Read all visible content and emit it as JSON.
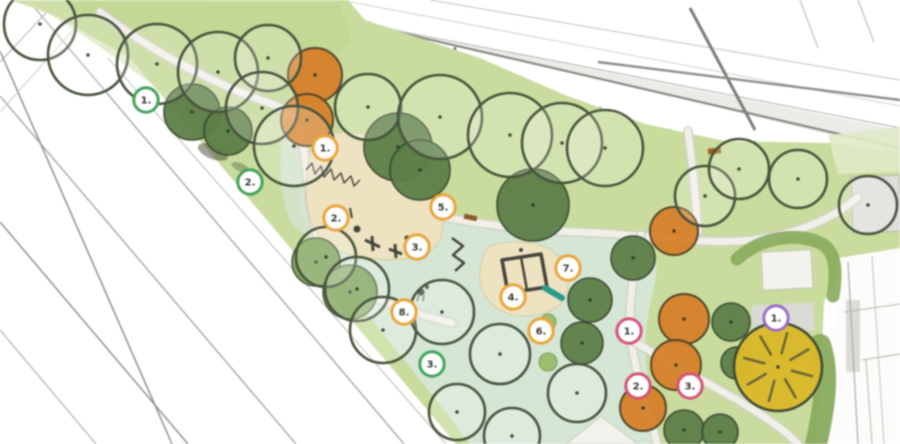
{
  "meta": {
    "width": 900,
    "height": 444,
    "description": "Park landscape site plan, top view"
  },
  "colors": {
    "canvas": "#ffffff",
    "lawn": "#c9dc9e",
    "lawn_shade": "#bdd48d",
    "lawn_light": "#e0eac8",
    "mint": "#d5e6d5",
    "sand": "#ede3c2",
    "sand_edge": "#d8caa2",
    "path_fill": "#f0efe8",
    "path_edge": "#cfcfc6",
    "paved": "#dededa",
    "hedge": "#8aab5f",
    "shrub": "#9dbd72",
    "equip": "#45443c",
    "teal": "#2b9b8b",
    "bench": "#8a5a2a",
    "tree_outline_stroke": "#48543e",
    "tree_dark": "#5d7f49",
    "tree_mid": "#7ca258",
    "tree_orange": "#d5822e",
    "tree_yellow": "#d9b92f",
    "marker_fill": "#ffffff",
    "marker_text": "#3a3a33",
    "ring_orange": "#eaa53e",
    "ring_green": "#46a25c",
    "ring_red": "#d45377",
    "ring_purple": "#9b6fc3"
  },
  "shapes": [
    {
      "k": "line",
      "x1": 126,
      "y1": 52,
      "x2": 460,
      "y2": 444,
      "w": 1.6,
      "c": "#96968f",
      "name": "street-edge"
    },
    {
      "k": "line",
      "x1": 108,
      "y1": 58,
      "x2": 446,
      "y2": 444,
      "w": 1,
      "c": "#b6b6b0",
      "name": "street-line"
    },
    {
      "k": "line",
      "x1": 28,
      "y1": 0,
      "x2": 404,
      "y2": 444,
      "w": 1.3,
      "c": "#a0a09a",
      "name": "street-line"
    },
    {
      "k": "line",
      "x1": 0,
      "y1": 96,
      "x2": 296,
      "y2": 444,
      "w": 1.3,
      "c": "#a0a09a",
      "name": "street-line"
    },
    {
      "k": "line",
      "x1": 0,
      "y1": 222,
      "x2": 188,
      "y2": 444,
      "w": 1.5,
      "c": "#92928c",
      "name": "street-line"
    },
    {
      "k": "line",
      "x1": 0,
      "y1": 330,
      "x2": 96,
      "y2": 444,
      "w": 1.1,
      "c": "#aaaaa4",
      "name": "street-line"
    },
    {
      "k": "line",
      "x1": 0,
      "y1": 51,
      "x2": 172,
      "y2": 444,
      "w": 1.5,
      "c": "#90908a",
      "name": "street-line"
    },
    {
      "k": "line",
      "x1": 0,
      "y1": 62,
      "x2": 58,
      "y2": 0,
      "w": 1.1,
      "c": "#a8a8a2",
      "name": "street-line"
    },
    {
      "k": "line",
      "x1": 0,
      "y1": 112,
      "x2": 100,
      "y2": 0,
      "w": 0.9,
      "c": "#c0c0ba",
      "name": "street-line"
    },
    {
      "k": "path",
      "d": "M 238,0 L 278,0 L 900,152 L 900,130 Z",
      "f": "#dadad6",
      "op": 0.55,
      "name": "road-band"
    },
    {
      "k": "line",
      "x1": 236,
      "y1": 0,
      "x2": 560,
      "y2": 62,
      "w": 1,
      "c": "#aeaea8",
      "name": "road-line"
    },
    {
      "k": "line",
      "x1": 560,
      "y1": 62,
      "x2": 900,
      "y2": 128,
      "w": 1,
      "c": "#aeaea8",
      "name": "road-line"
    },
    {
      "k": "line",
      "x1": 258,
      "y1": 0,
      "x2": 900,
      "y2": 148,
      "w": 2.2,
      "c": "#8a8a85",
      "name": "road-line"
    },
    {
      "k": "line",
      "x1": 430,
      "y1": 0,
      "x2": 900,
      "y2": 80,
      "w": 1,
      "c": "#c2c2bc",
      "name": "building-line"
    },
    {
      "k": "line",
      "x1": 340,
      "y1": 0,
      "x2": 900,
      "y2": 106,
      "w": 0.8,
      "c": "#c8c8c2",
      "name": "building-line"
    },
    {
      "k": "line",
      "x1": 690,
      "y1": 8,
      "x2": 755,
      "y2": 130,
      "w": 3,
      "c": "#7d7d78",
      "name": "road-line"
    },
    {
      "k": "line",
      "x1": 598,
      "y1": 62,
      "x2": 900,
      "y2": 100,
      "w": 2.4,
      "c": "#8d8d88",
      "name": "road-line"
    },
    {
      "k": "line",
      "x1": 800,
      "y1": 0,
      "x2": 818,
      "y2": 48,
      "w": 1,
      "c": "#b0b0aa",
      "name": "building-line"
    },
    {
      "k": "line",
      "x1": 858,
      "y1": 0,
      "x2": 874,
      "y2": 42,
      "w": 1,
      "c": "#b0b0aa",
      "name": "building-line"
    },
    {
      "k": "line",
      "x1": 455,
      "y1": 47,
      "x2": 455,
      "y2": 74,
      "w": 2.4,
      "c": "#70706b",
      "name": "fence-post"
    },
    {
      "k": "line",
      "x1": 525,
      "y1": 78,
      "x2": 525,
      "y2": 105,
      "w": 2.4,
      "c": "#70706b",
      "name": "fence-post"
    },
    {
      "k": "line",
      "x1": 600,
      "y1": 107,
      "x2": 600,
      "y2": 134,
      "w": 2.4,
      "c": "#70706b",
      "name": "fence-post"
    },
    {
      "k": "line",
      "x1": 670,
      "y1": 129,
      "x2": 670,
      "y2": 156,
      "w": 2.4,
      "c": "#70706b",
      "name": "fence-post"
    },
    {
      "k": "line",
      "x1": 755,
      "y1": 141,
      "x2": 755,
      "y2": 168,
      "w": 2.4,
      "c": "#70706b",
      "name": "fence-post"
    },
    {
      "k": "line",
      "x1": 825,
      "y1": 143,
      "x2": 825,
      "y2": 170,
      "w": 2.4,
      "c": "#70706b",
      "name": "fence-post"
    },
    {
      "k": "line",
      "x1": 888,
      "y1": 149,
      "x2": 888,
      "y2": 176,
      "w": 2.4,
      "c": "#70706b",
      "name": "fence-post"
    },
    {
      "k": "path",
      "d": "M 10,0 L 348,0 L 365,20 L 480,58 L 565,95 L 645,124 L 725,141 L 832,143 L 900,153 L 900,250 L 842,264 L 824,302 L 818,444 L 456,444 L 130,58 L 56,16 Z",
      "f": "$lawn",
      "name": "park-lawn"
    },
    {
      "k": "path",
      "d": "M 30,2 L 340,4 L 352,40 L 270,120 L 160,90 L 90,40 Z",
      "f": "$lawn_shade",
      "op": 0.5,
      "name": "lawn-shade"
    },
    {
      "k": "path",
      "d": "M 828,135 L 900,127 L 900,172 L 838,174 Z",
      "f": "$lawn_light",
      "op": 0.9,
      "name": "lawn-light-patch"
    },
    {
      "k": "path",
      "d": "M 303,186 C 360,202 440,218 520,228 C 575,234 620,236 641,234 C 655,252 659,260 655,282 C 649,312 643,332 646,362 C 649,396 657,420 655,444 L 470,444 C 448,414 420,380 392,345 C 362,308 330,262 310,230 C 300,212 298,196 303,186 Z",
      "f": "$mint",
      "name": "play-lawn"
    },
    {
      "k": "path",
      "d": "M 283,132 C 295,136 302,140 304,146 C 302,168 305,200 317,240 C 307,236 296,230 290,220 C 280,196 278,158 283,132 Z",
      "f": "$mint",
      "op": 0.75,
      "name": "play-lawn-strip"
    },
    {
      "k": "rect",
      "x": 852,
      "y": 176,
      "w": 48,
      "h": 56,
      "f": "$paved",
      "s": "#b8b8b2",
      "sw": 1,
      "rot": -2,
      "name": "paved-square"
    },
    {
      "k": "walk",
      "d": "M 100,12 C 160,58 225,88 272,104 C 300,115 299,128 304,150 C 310,190 308,214 322,248 C 338,284 380,302 418,314 C 432,318 442,320 452,323",
      "name": "path-west"
    },
    {
      "k": "walk",
      "d": "M 420,212 C 480,226 540,231 600,233 C 655,237 700,243 740,241 C 788,238 832,220 858,197",
      "name": "path-north"
    },
    {
      "k": "walk",
      "d": "M 641,235 C 635,270 627,300 631,338 C 635,374 649,410 657,444",
      "name": "path-east"
    },
    {
      "k": "walk",
      "d": "M 633,341 C 669,363 701,379 739,401 C 767,418 786,431 798,444",
      "name": "path-southeast"
    },
    {
      "k": "walk",
      "d": "M 688,131 C 692,162 696,196 698,232",
      "name": "path-north-spur"
    },
    {
      "k": "path",
      "d": "M 566,444 L 601,416 L 638,444 Z",
      "f": "#f2f2ec",
      "s": "#c8c8c0",
      "sw": 1,
      "name": "plaza-south"
    },
    {
      "k": "path",
      "d": "M 322,134 C 360,128 400,140 412,158 C 421,172 428,190 438,210 C 448,228 442,248 420,256 C 390,264 350,258 330,246 C 314,236 306,214 306,192 C 306,168 310,140 322,134 Z",
      "f": "$sand",
      "s": "$sand_edge",
      "sw": 1,
      "name": "sand-area-west"
    },
    {
      "k": "path",
      "d": "M 490,246 C 515,238 545,242 558,256 C 570,268 572,288 562,302 C 550,316 522,320 504,312 C 486,304 478,288 480,270 C 482,258 484,250 490,246 Z",
      "f": "$sand",
      "s": "$sand_edge",
      "sw": 1,
      "name": "sand-area-central"
    },
    {
      "k": "path",
      "d": "M 838,258 L 900,248 L 900,444 L 826,444 Z",
      "f": "#fcfcfa",
      "name": "building-right"
    },
    {
      "k": "rect",
      "x": 846,
      "y": 300,
      "w": 14,
      "h": 72,
      "f": "#dcdcd7",
      "rot": 0,
      "name": "building-detail"
    },
    {
      "k": "line",
      "x1": 848,
      "y1": 262,
      "x2": 858,
      "y2": 444,
      "w": 1.2,
      "c": "#ababa6",
      "name": "building-line"
    },
    {
      "k": "line",
      "x1": 872,
      "y1": 256,
      "x2": 884,
      "y2": 444,
      "w": 1,
      "c": "#c2c2bc",
      "name": "building-line"
    },
    {
      "k": "line",
      "x1": 844,
      "y1": 312,
      "x2": 900,
      "y2": 304,
      "w": 1,
      "c": "#b4b4ae",
      "name": "building-line"
    },
    {
      "k": "line",
      "x1": 862,
      "y1": 360,
      "x2": 900,
      "y2": 354,
      "w": 1,
      "c": "#b4b4ae",
      "name": "building-line"
    },
    {
      "k": "line",
      "x1": 866,
      "y1": 360,
      "x2": 872,
      "y2": 444,
      "w": 1,
      "c": "#b4b4ae",
      "name": "building-line"
    },
    {
      "k": "rect",
      "x": 762,
      "y": 251,
      "w": 50,
      "h": 38,
      "f": "#f3f3ee",
      "s": "#c2c2bb",
      "sw": 1,
      "rot": -3,
      "name": "paved-white-square"
    },
    {
      "k": "rect",
      "x": 752,
      "y": 304,
      "w": 62,
      "h": 28,
      "f": "#dadad5",
      "rot": -3,
      "name": "paved-pad"
    },
    {
      "k": "path",
      "d": "M 737,259 C 762,236 800,232 822,244 C 836,252 837,272 833,296",
      "s": "$hedge",
      "sw": 13,
      "f": "none",
      "op": 0.92,
      "cap": "round",
      "name": "hedge-arc"
    },
    {
      "k": "path",
      "d": "M 820,345 C 829,372 825,405 816,444",
      "s": "$hedge",
      "sw": 22,
      "f": "none",
      "op": 0.95,
      "cap": "round",
      "name": "hedge-strip"
    },
    {
      "k": "path",
      "d": "M 306,170 l 6,-7 l 3,11 l 6,-8 l 3,11 l 7,-8 l 3,11 l 7,-7 l 3,10 l 7,-7 l 3,10 l 6,-6",
      "s": "$equip",
      "sw": 1.4,
      "f": "none",
      "name": "fence"
    },
    {
      "k": "ellipse",
      "cx": 213,
      "cy": 152,
      "rx": 16,
      "ry": 7,
      "rot": 22,
      "f": "#3f4636",
      "op": 0.5,
      "name": "shrub-shadow"
    },
    {
      "k": "ellipse",
      "cx": 240,
      "cy": 167,
      "rx": 9,
      "ry": 4,
      "rot": 22,
      "f": "#3f4636",
      "op": 0.35,
      "name": "shrub-shadow"
    },
    {
      "k": "line",
      "x1": 365,
      "y1": 240,
      "x2": 380,
      "y2": 247,
      "w": 3,
      "c": "$equip",
      "name": "play-equipment"
    },
    {
      "k": "line",
      "x1": 372,
      "y1": 236,
      "x2": 373,
      "y2": 251,
      "w": 3,
      "c": "$equip",
      "name": "play-equipment"
    },
    {
      "k": "circle",
      "cx": 357,
      "cy": 229,
      "r": 3.5,
      "f": "$equip",
      "name": "play-equipment"
    },
    {
      "k": "line",
      "x1": 389,
      "y1": 249,
      "x2": 402,
      "y2": 254,
      "w": 3,
      "c": "$equip",
      "name": "play-equipment"
    },
    {
      "k": "line",
      "x1": 395,
      "y1": 244,
      "x2": 396,
      "y2": 258,
      "w": 3,
      "c": "$equip",
      "name": "play-equipment"
    },
    {
      "k": "circle",
      "cx": 407,
      "cy": 238,
      "r": 2.5,
      "f": "$equip",
      "name": "play-equipment"
    },
    {
      "k": "line",
      "x1": 342,
      "y1": 206,
      "x2": 344,
      "y2": 216,
      "w": 2,
      "c": "$equip",
      "name": "play-pole"
    },
    {
      "k": "line",
      "x1": 350,
      "y1": 208,
      "x2": 352,
      "y2": 218,
      "w": 2,
      "c": "$equip",
      "name": "play-pole"
    },
    {
      "k": "path",
      "d": "M 452,238 L 463,246 L 453,255 L 464,263 L 455,271",
      "s": "$equip",
      "sw": 2.5,
      "f": "none",
      "name": "balance-beam"
    },
    {
      "k": "path",
      "d": "M 502,260 L 541,254 L 547,287 L 508,293 Z",
      "s": "$equip",
      "sw": 3.5,
      "f": "none",
      "name": "climbing-frame"
    },
    {
      "k": "line",
      "x1": 521,
      "y1": 257,
      "x2": 527,
      "y2": 290,
      "w": 2.5,
      "c": "$equip",
      "name": "climbing-frame-bar"
    },
    {
      "k": "line",
      "x1": 545,
      "y1": 288,
      "x2": 562,
      "y2": 298,
      "w": 6,
      "c": "$teal",
      "cap": "round",
      "name": "slide"
    },
    {
      "k": "circle",
      "cx": 421,
      "cy": 292,
      "r": 3.5,
      "f": "$equip",
      "name": "bird-sculpture"
    },
    {
      "k": "circle",
      "cx": 427,
      "cy": 287,
      "r": 2,
      "f": "$equip",
      "name": "bird-sculpture"
    },
    {
      "k": "line",
      "x1": 419,
      "y1": 295,
      "x2": 417,
      "y2": 301,
      "w": 1,
      "c": "$equip",
      "name": "bird-sculpture"
    },
    {
      "k": "line",
      "x1": 424,
      "y1": 295,
      "x2": 423,
      "y2": 301,
      "w": 1,
      "c": "$equip",
      "name": "bird-sculpture"
    },
    {
      "k": "rect",
      "x": 464,
      "y": 215,
      "w": 13,
      "h": 5,
      "f": "$bench",
      "rot": 12,
      "name": "bench"
    },
    {
      "k": "rect",
      "x": 708,
      "y": 148,
      "w": 13,
      "h": 6,
      "f": "#a2601e",
      "rot": -6,
      "name": "bench"
    },
    {
      "k": "circle",
      "cx": 521,
      "cy": 250,
      "r": 2,
      "f": "$equip",
      "name": "stump"
    },
    {
      "k": "circle",
      "cx": 548,
      "cy": 322,
      "r": 8,
      "f": "$shrub",
      "s": "#7d9d52",
      "sw": 1,
      "name": "shrub"
    },
    {
      "k": "circle",
      "cx": 548,
      "cy": 362,
      "r": 9,
      "f": "$shrub",
      "s": "#7d9d52",
      "sw": 1,
      "name": "shrub"
    }
  ],
  "trees": [
    {
      "x": 192,
      "y": 112,
      "r": 28,
      "t": "dark"
    },
    {
      "x": 228,
      "y": 131,
      "r": 24,
      "t": "dark"
    },
    {
      "x": 398,
      "y": 147,
      "r": 34,
      "t": "dark"
    },
    {
      "x": 420,
      "y": 170,
      "r": 30,
      "t": "dark"
    },
    {
      "x": 533,
      "y": 205,
      "r": 36,
      "t": "dark"
    },
    {
      "x": 590,
      "y": 300,
      "r": 22,
      "t": "dark"
    },
    {
      "x": 582,
      "y": 343,
      "r": 21,
      "t": "dark"
    },
    {
      "x": 633,
      "y": 258,
      "r": 22,
      "t": "dark"
    },
    {
      "x": 731,
      "y": 322,
      "r": 19,
      "t": "dark"
    },
    {
      "x": 737,
      "y": 363,
      "r": 16,
      "t": "dark"
    },
    {
      "x": 684,
      "y": 430,
      "r": 20,
      "t": "dark"
    },
    {
      "x": 720,
      "y": 432,
      "r": 18,
      "t": "dark"
    },
    {
      "x": 316,
      "y": 262,
      "r": 24,
      "t": "mid"
    },
    {
      "x": 350,
      "y": 292,
      "r": 27,
      "t": "mid"
    },
    {
      "x": 315,
      "y": 75,
      "r": 27,
      "t": "orange"
    },
    {
      "x": 307,
      "y": 120,
      "r": 26,
      "t": "orange"
    },
    {
      "x": 674,
      "y": 231,
      "r": 24,
      "t": "orange"
    },
    {
      "x": 684,
      "y": 319,
      "r": 25,
      "t": "orange"
    },
    {
      "x": 676,
      "y": 365,
      "r": 25,
      "t": "orange"
    },
    {
      "x": 643,
      "y": 408,
      "r": 23,
      "t": "orange"
    },
    {
      "x": 40,
      "y": 24,
      "r": 36,
      "t": "outline"
    },
    {
      "x": 88,
      "y": 55,
      "r": 40,
      "t": "outline"
    },
    {
      "x": 157,
      "y": 64,
      "r": 40,
      "t": "outline"
    },
    {
      "x": 218,
      "y": 72,
      "r": 40,
      "t": "outline"
    },
    {
      "x": 268,
      "y": 58,
      "r": 33,
      "t": "outline"
    },
    {
      "x": 262,
      "y": 108,
      "r": 36,
      "t": "outline"
    },
    {
      "x": 294,
      "y": 146,
      "r": 40,
      "t": "outline"
    },
    {
      "x": 368,
      "y": 107,
      "r": 33,
      "t": "outline"
    },
    {
      "x": 440,
      "y": 117,
      "r": 42,
      "t": "outline"
    },
    {
      "x": 510,
      "y": 135,
      "r": 42,
      "t": "outline"
    },
    {
      "x": 562,
      "y": 143,
      "r": 40,
      "t": "outline"
    },
    {
      "x": 605,
      "y": 148,
      "r": 38,
      "t": "outline"
    },
    {
      "x": 705,
      "y": 196,
      "r": 30,
      "t": "outline"
    },
    {
      "x": 739,
      "y": 169,
      "r": 30,
      "t": "outline"
    },
    {
      "x": 798,
      "y": 179,
      "r": 29,
      "t": "outline"
    },
    {
      "x": 868,
      "y": 205,
      "r": 29,
      "t": "outline"
    },
    {
      "x": 326,
      "y": 257,
      "r": 30,
      "t": "outline"
    },
    {
      "x": 357,
      "y": 289,
      "r": 32,
      "t": "outline"
    },
    {
      "x": 383,
      "y": 330,
      "r": 33,
      "t": "outline"
    },
    {
      "x": 442,
      "y": 312,
      "r": 32,
      "t": "outline"
    },
    {
      "x": 500,
      "y": 354,
      "r": 30,
      "t": "outline"
    },
    {
      "x": 577,
      "y": 393,
      "r": 29,
      "t": "outline"
    },
    {
      "x": 457,
      "y": 412,
      "r": 28,
      "t": "outline"
    },
    {
      "x": 512,
      "y": 436,
      "r": 28,
      "t": "outline"
    },
    {
      "x": 778,
      "y": 367,
      "r": 44,
      "t": "yellow"
    }
  ],
  "markers": [
    {
      "label": "1.",
      "ring": "green",
      "x": 146,
      "y": 100
    },
    {
      "label": "2.",
      "ring": "green",
      "x": 250,
      "y": 182
    },
    {
      "label": "3.",
      "ring": "green",
      "x": 432,
      "y": 364
    },
    {
      "label": "1.",
      "ring": "orange",
      "x": 325,
      "y": 148
    },
    {
      "label": "2.",
      "ring": "orange",
      "x": 336,
      "y": 218
    },
    {
      "label": "3.",
      "ring": "orange",
      "x": 417,
      "y": 247
    },
    {
      "label": "4.",
      "ring": "orange",
      "x": 513,
      "y": 297
    },
    {
      "label": "5.",
      "ring": "orange",
      "x": 443,
      "y": 207
    },
    {
      "label": "6.",
      "ring": "orange",
      "x": 541,
      "y": 331
    },
    {
      "label": "7.",
      "ring": "orange",
      "x": 568,
      "y": 268
    },
    {
      "label": "8.",
      "ring": "orange",
      "x": 404,
      "y": 312
    },
    {
      "label": "1.",
      "ring": "red",
      "x": 629,
      "y": 331
    },
    {
      "label": "2.",
      "ring": "red",
      "x": 638,
      "y": 386
    },
    {
      "label": "3.",
      "ring": "red",
      "x": 690,
      "y": 386
    },
    {
      "label": "1.",
      "ring": "purple",
      "x": 776,
      "y": 318
    }
  ]
}
